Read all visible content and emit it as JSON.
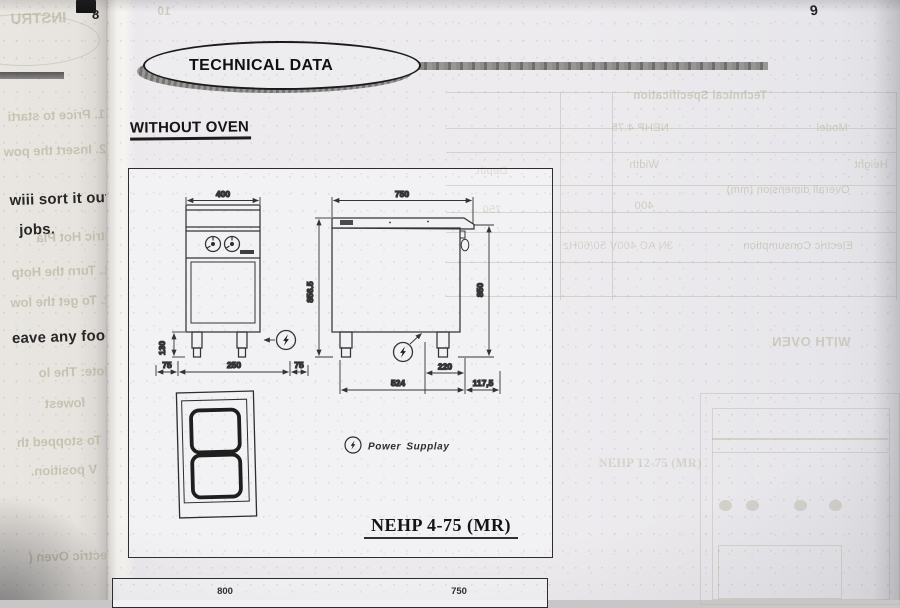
{
  "left_page": {
    "page_number": "8",
    "lines": {
      "instr_mirrored": "INSTRU",
      "price": "1.  Price to starti",
      "insert": "2.  Insert the pow",
      "sort": "wiii sort it out",
      "jobs": "jobs.",
      "hotplate": "Electric Hot Pla",
      "turn": "1. Turn the Hotp",
      "get_low": "2. To get the low",
      "food": "eave any food",
      "note": "Note: The lo",
      "lowest": "lowest",
      "stopped": "3. To stopped th",
      "position": "V position.",
      "oven": "Electric Oven ("
    }
  },
  "page": {
    "page_number": "9",
    "header_title": "TECHNICAL DATA",
    "section_heading": "WITHOUT OVEN",
    "figure": {
      "title": "NEHP 4-75 (MR)",
      "legend_label": "Power Supplay",
      "front_view": {
        "width_dim": "400",
        "leg_height_dim": "130",
        "bottom_dims": [
          "75",
          "250",
          "75"
        ]
      },
      "side_view": {
        "depth_dim": "750",
        "height_left_dim": "856.5",
        "height_right_dim": "850",
        "leg_spacing_dim": "220",
        "bottom_left_dim": "524",
        "bottom_right_dim": "117,5"
      }
    },
    "next_figure": {
      "left_dim": "800",
      "right_dim": "750"
    },
    "bleed": {
      "page_number_ghost": "10",
      "table_title": "Technical Specification",
      "model_label": "Model",
      "model_value": "NEHP 4.75",
      "width_label": "Width",
      "depth_label": "Depth",
      "height_label": "Height",
      "overall_dim_label": "Overall dimension (mm)",
      "width_value": "400",
      "depth_value": "750",
      "electric_label": "Electric Consumption",
      "electric_value": "3N AC 400V  50/60Hz",
      "with_oven": "WITH OVEN",
      "ghost_figure_title": "NEHP 12-75 (MR)"
    }
  },
  "colors": {
    "ink": "#1f1f1f",
    "paper": "#eceaed",
    "bleed_ink": "#b7b39b"
  }
}
